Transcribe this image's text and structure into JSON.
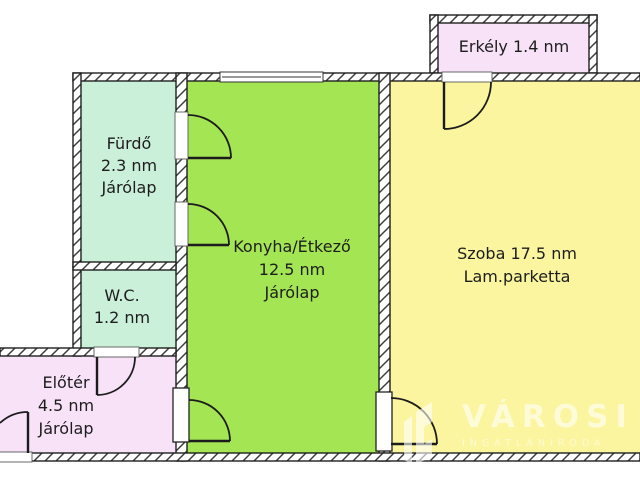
{
  "rooms": {
    "erkely": {
      "lines": [
        "Erkély 1.4 nm"
      ],
      "fill": "#F8E2F8"
    },
    "furdo": {
      "lines": [
        "Fürdő",
        "2.3 nm",
        "Járólap"
      ],
      "fill": "#CBF0DA"
    },
    "wc": {
      "lines": [
        "W.C.",
        "1.2 nm"
      ],
      "fill": "#CBF0DA"
    },
    "eloter": {
      "lines": [
        "Előtér",
        "4.5 nm",
        "Járólap"
      ],
      "fill": "#F8E2F8"
    },
    "konyha": {
      "lines": [
        "Konyha/Étkező",
        "12.5 nm",
        "Járólap"
      ],
      "fill": "#A4E553"
    },
    "szoba": {
      "lines": [
        "Szoba 17.5 nm",
        "Lam.parketta"
      ],
      "fill": "#FAF59E"
    }
  },
  "watermark": {
    "brand": "VÁROSI",
    "subtitle": "INGATLANIRODA",
    "color": "#FFFFFF"
  }
}
